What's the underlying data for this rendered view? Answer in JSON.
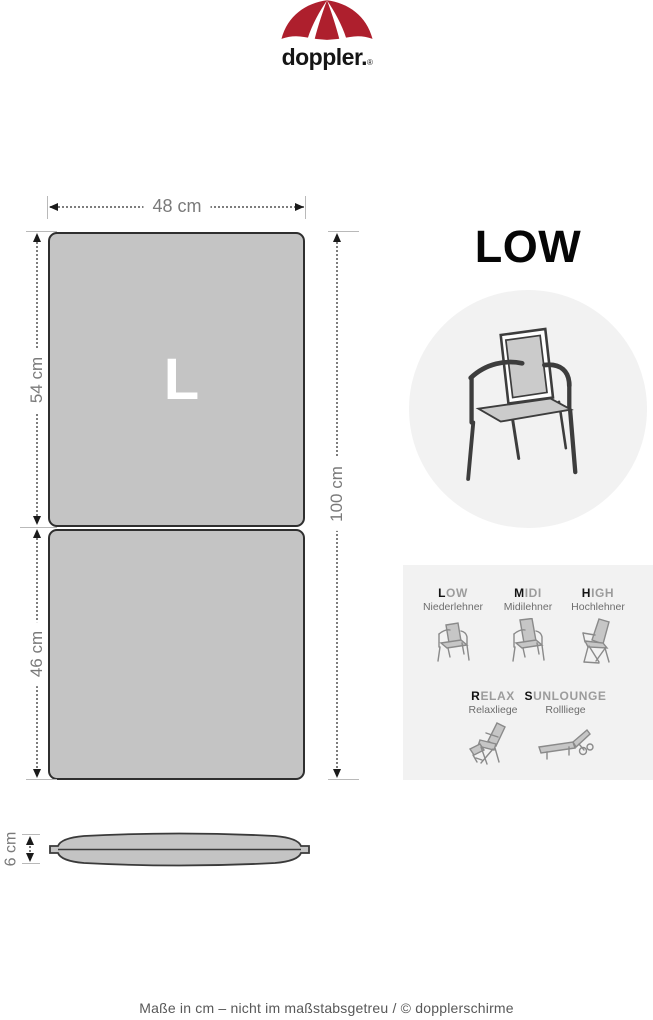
{
  "colors": {
    "brand_red": "#ae1f2d",
    "cushion_gray": "#c4c4c4",
    "panel_gray": "#f2f2f2"
  },
  "logo": {
    "icon": "umbrella-icon",
    "brand": "doppler.",
    "registered": "®"
  },
  "cushion": {
    "size_letter": "L",
    "views": [
      "top-view",
      "side-view"
    ]
  },
  "dimensions": {
    "width": "48 cm",
    "back_section": "54 cm",
    "seat_section": "46 cm",
    "total_length": "100 cm",
    "thickness": "6 cm"
  },
  "type": {
    "title": "LOW",
    "icon": "low-armchair-icon"
  },
  "legend": {
    "items": [
      {
        "code_first": "L",
        "code_rest": "OW",
        "label": "Niederlehner",
        "icon": "low-chair-icon"
      },
      {
        "code_first": "M",
        "code_rest": "IDI",
        "label": "Midilehner",
        "icon": "midi-chair-icon"
      },
      {
        "code_first": "H",
        "code_rest": "IGH",
        "label": "Hochlehner",
        "icon": "high-chair-icon"
      },
      {
        "code_first": "R",
        "code_rest": "ELAX",
        "label": "Relaxliege",
        "icon": "relax-chair-icon"
      },
      {
        "code_first": "S",
        "code_rest": "UNLOUNGE",
        "label": "Rollliege",
        "icon": "sunlounge-icon"
      }
    ]
  },
  "footer": {
    "text": "Maße in cm – nicht im maßstabsgetreu / © dopplerschirme"
  }
}
